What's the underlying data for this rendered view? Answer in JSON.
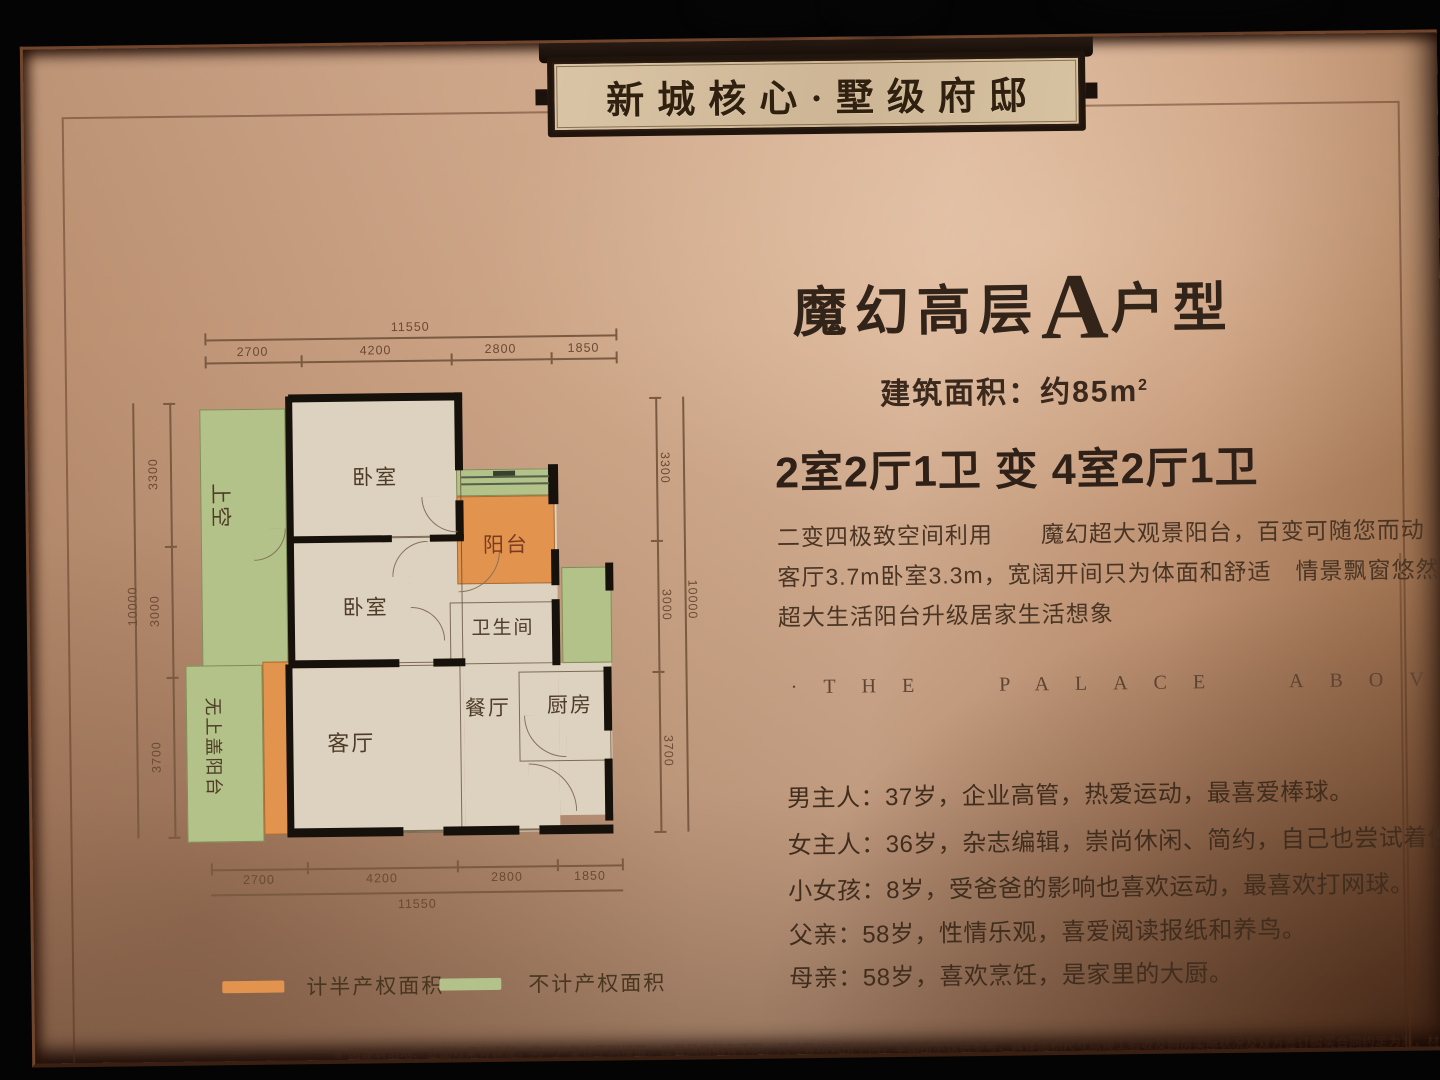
{
  "plaque": {
    "title": "新城核心·墅级府邸"
  },
  "unit": {
    "title_prefix": "魔幻高层",
    "title_letter": "A",
    "title_suffix": "户型",
    "area_prefix": "建筑面积：约85",
    "area_unit": "m",
    "area_sup": "2",
    "layout": "2室2厅1卫  变 4室2厅1卫",
    "desc_lines": [
      "二变四极致空间利用　　魔幻超大观景阳台，百变可随您而动",
      "客厅3.7m卧室3.3m，宽阔开间只为体面和舒适　情景飘窗悠然悦尽王府园林百态",
      "超大生活阳台升级居家生活想象"
    ],
    "english": {
      "left_dot": "·",
      "text": "THE PALACE ABOVE",
      "right_dot": "·"
    },
    "family_lines": [
      "男主人：37岁，企业高管，热爱运动，最喜爱棒球。",
      "女主人：36岁，杂志编辑，崇尚休闲、简约，自己也尝试着做些DIY设计。",
      "小女孩：8岁，受爸爸的影响也喜欢运动，最喜欢打网球。",
      "父亲：58岁，性情乐观，喜爱阅读报纸和养鸟。",
      "母亲：58岁，喜欢烹饪，是家里的大厨。"
    ]
  },
  "floorplan": {
    "rooms": {
      "shangkong": "上空",
      "bedroom1": "卧室",
      "bedroom2": "卧室",
      "balcony": "阳台",
      "bathroom": "卫生间",
      "dining": "餐厅",
      "kitchen": "厨房",
      "living": "客厅",
      "open_balcony": "无上盖阳台"
    },
    "dims": {
      "top_total": "11550",
      "top_segments": [
        "2700",
        "4200",
        "2800",
        "1850"
      ],
      "bottom_segments": [
        "2700",
        "4200",
        "2800",
        "1850"
      ],
      "bottom_total": "11550",
      "left_total": "10000",
      "left_segments": [
        "3300",
        "3000",
        "3700"
      ],
      "right_segments": [
        "3300",
        "3000",
        "3700"
      ],
      "right_total": "10000"
    },
    "legend": [
      {
        "color": "#e2944f",
        "label": "计半产权面积"
      },
      {
        "color": "#b3c289",
        "label": "不计产权面积"
      }
    ]
  },
  "colors": {
    "board": "#cda286",
    "ink": "#3a291c",
    "half_property": "#e2944f",
    "non_property": "#b3c289"
  },
  "disclaimer": "※ 因建筑沿地、立面效果有调整，同一户型在不同楼层、位置风格稍有不同，尺寸等均有所不同，本图所示仅供参考，具体面积尺寸以竣工验收及购房实际状况及双方签订购买合同约定为准，材料色彩仅供展示，非交房标准。"
}
